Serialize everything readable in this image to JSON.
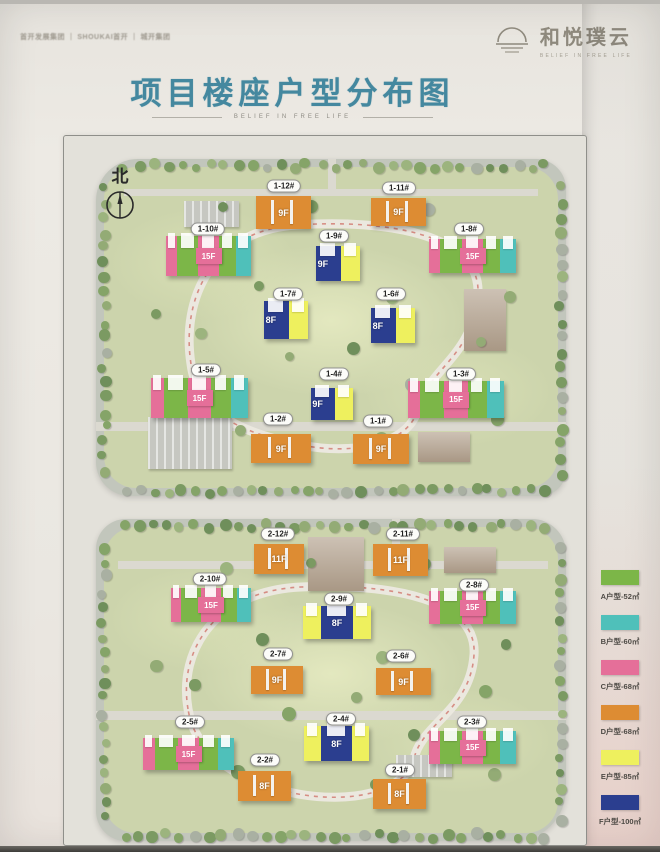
{
  "header": {
    "logos_left": "首开发展集团 ｜ SHOUKAI首开 ｜ 城开集团",
    "brand_name": "和悦璞云",
    "brand_tagline": "BELIEF IN FREE LIFE"
  },
  "title": "项目楼座户型分布图",
  "subtitle": "BELIEF IN FREE LIFE",
  "north_label": "北",
  "unit_colors": {
    "A": "#7cb648",
    "B": "#4fc0ba",
    "C": "#e56f99",
    "D": "#dd8c33",
    "E": "#eef05e",
    "F": "#2b3e8f"
  },
  "legend": {
    "items": [
      {
        "key": "A",
        "label": "A户型-52㎡"
      },
      {
        "key": "B",
        "label": "B户型-60㎡"
      },
      {
        "key": "C",
        "label": "C户型-68㎡"
      },
      {
        "key": "D",
        "label": "D户型-68㎡"
      },
      {
        "key": "E",
        "label": "E户型-85㎡"
      },
      {
        "key": "F",
        "label": "F户型-100㎡"
      }
    ]
  },
  "plans": [
    {
      "name": "phase-1",
      "buildings": [
        {
          "label": "1-12#",
          "floors": "9F",
          "type": "orange",
          "pill": [
            188,
            27
          ],
          "body": [
            160,
            37,
            55,
            33
          ]
        },
        {
          "label": "1-11#",
          "floors": "9F",
          "type": "orange",
          "pill": [
            303,
            29
          ],
          "body": [
            275,
            39,
            55,
            28
          ]
        },
        {
          "label": "1-10#",
          "floors": "15F",
          "type": "slab",
          "pill": [
            112,
            70
          ],
          "body": [
            70,
            77,
            85,
            40
          ]
        },
        {
          "label": "1-9#",
          "floors": "9F",
          "type": "blue",
          "pill": [
            238,
            77
          ],
          "body": [
            220,
            87,
            44,
            35
          ]
        },
        {
          "label": "1-8#",
          "floors": "15F",
          "type": "slab",
          "pill": [
            373,
            70
          ],
          "body": [
            333,
            80,
            87,
            34
          ]
        },
        {
          "label": "1-7#",
          "floors": "8F",
          "type": "blue",
          "pill": [
            192,
            135
          ],
          "body": [
            168,
            142,
            44,
            38
          ]
        },
        {
          "label": "1-6#",
          "floors": "8F",
          "type": "blue",
          "pill": [
            295,
            135
          ],
          "body": [
            275,
            149,
            44,
            35
          ]
        },
        {
          "label": "1-5#",
          "floors": "15F",
          "type": "slab",
          "pill": [
            110,
            211
          ],
          "body": [
            55,
            219,
            97,
            40
          ]
        },
        {
          "label": "1-4#",
          "floors": "9F",
          "type": "blue",
          "pill": [
            238,
            215
          ],
          "body": [
            215,
            229,
            42,
            32
          ]
        },
        {
          "label": "1-3#",
          "floors": "15F",
          "type": "slab",
          "pill": [
            365,
            215
          ],
          "body": [
            312,
            222,
            96,
            37
          ]
        },
        {
          "label": "1-2#",
          "floors": "9F",
          "type": "orange",
          "pill": [
            182,
            260
          ],
          "body": [
            155,
            275,
            60,
            29
          ]
        },
        {
          "label": "1-1#",
          "floors": "9F",
          "type": "orange",
          "pill": [
            282,
            262
          ],
          "body": [
            257,
            275,
            56,
            30
          ]
        }
      ]
    },
    {
      "name": "phase-2",
      "buildings": [
        {
          "label": "2-12#",
          "floors": "11F",
          "type": "orange",
          "pill": [
            182,
            15
          ],
          "body": [
            158,
            25,
            50,
            30
          ]
        },
        {
          "label": "2-11#",
          "floors": "11F",
          "type": "orange",
          "pill": [
            307,
            15
          ],
          "body": [
            277,
            25,
            55,
            32
          ]
        },
        {
          "label": "2-10#",
          "floors": "15F",
          "type": "slab",
          "pill": [
            114,
            60
          ],
          "body": [
            75,
            69,
            80,
            34
          ]
        },
        {
          "label": "2-9#",
          "floors": "8F",
          "type": "blue-mid",
          "pill": [
            243,
            80
          ],
          "body": [
            207,
            87,
            68,
            33
          ]
        },
        {
          "label": "2-8#",
          "floors": "15F",
          "type": "slab",
          "pill": [
            378,
            66
          ],
          "body": [
            333,
            72,
            87,
            33
          ]
        },
        {
          "label": "2-7#",
          "floors": "9F",
          "type": "orange",
          "pill": [
            182,
            135
          ],
          "body": [
            155,
            147,
            52,
            28
          ]
        },
        {
          "label": "2-6#",
          "floors": "9F",
          "type": "orange",
          "pill": [
            305,
            137
          ],
          "body": [
            280,
            149,
            55,
            27
          ]
        },
        {
          "label": "2-5#",
          "floors": "15F",
          "type": "slab",
          "pill": [
            94,
            203
          ],
          "body": [
            47,
            219,
            91,
            32
          ]
        },
        {
          "label": "2-4#",
          "floors": "8F",
          "type": "blue-mid",
          "pill": [
            245,
            200
          ],
          "body": [
            208,
            207,
            65,
            35
          ]
        },
        {
          "label": "2-3#",
          "floors": "15F",
          "type": "slab",
          "pill": [
            376,
            203
          ],
          "body": [
            333,
            212,
            87,
            33
          ]
        },
        {
          "label": "2-2#",
          "floors": "8F",
          "type": "orange",
          "pill": [
            169,
            241
          ],
          "body": [
            142,
            252,
            53,
            30
          ]
        },
        {
          "label": "2-1#",
          "floors": "8F",
          "type": "orange",
          "pill": [
            304,
            251
          ],
          "body": [
            277,
            260,
            53,
            30
          ]
        }
      ]
    }
  ]
}
